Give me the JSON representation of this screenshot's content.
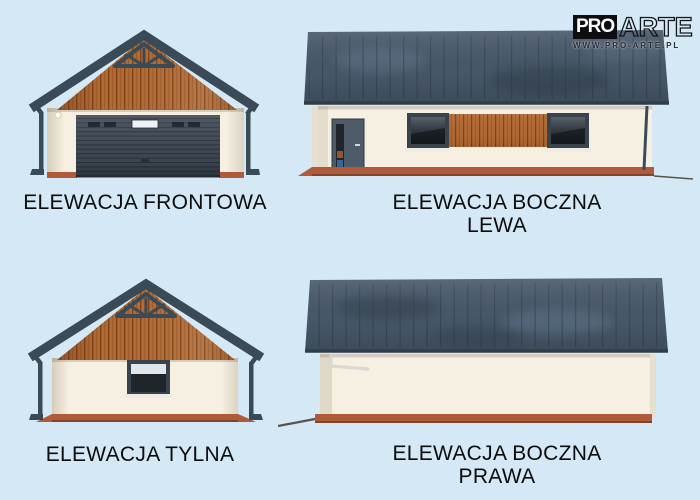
{
  "logo": {
    "pro": "PRO",
    "arte": "ARTE",
    "website": "WWW.PRO-ARTE.PL"
  },
  "elevations": {
    "front": {
      "label": "ELEWACJA FRONTOWA"
    },
    "side_left": {
      "label": "ELEWACJA BOCZNA",
      "sublabel": "LEWA"
    },
    "rear": {
      "label": "ELEWACJA TYLNA"
    },
    "side_right": {
      "label": "ELEWACJA BOCZNA",
      "sublabel": "PRAWA"
    }
  },
  "colors": {
    "background": "#d5e8f5",
    "roof": "#48596a",
    "roof_dark": "#3b4a57",
    "roof_seam": "#2e3c48",
    "wood": "#b26a34",
    "wood_dark": "#7e4418",
    "wood_mid": "#9a5826",
    "wall": "#f6f0e2",
    "plinth": "#b05a3c",
    "garage_door": "#3e4954",
    "door_leaf": "#4e5c69",
    "frame": "#39434e",
    "glass_dark": "#20252c",
    "glass_light": "#dfe6ec",
    "sill": "#edebe2",
    "gutter_light": "#d9d9d2",
    "ground": "#59544b",
    "text": "#0c0c0c"
  }
}
